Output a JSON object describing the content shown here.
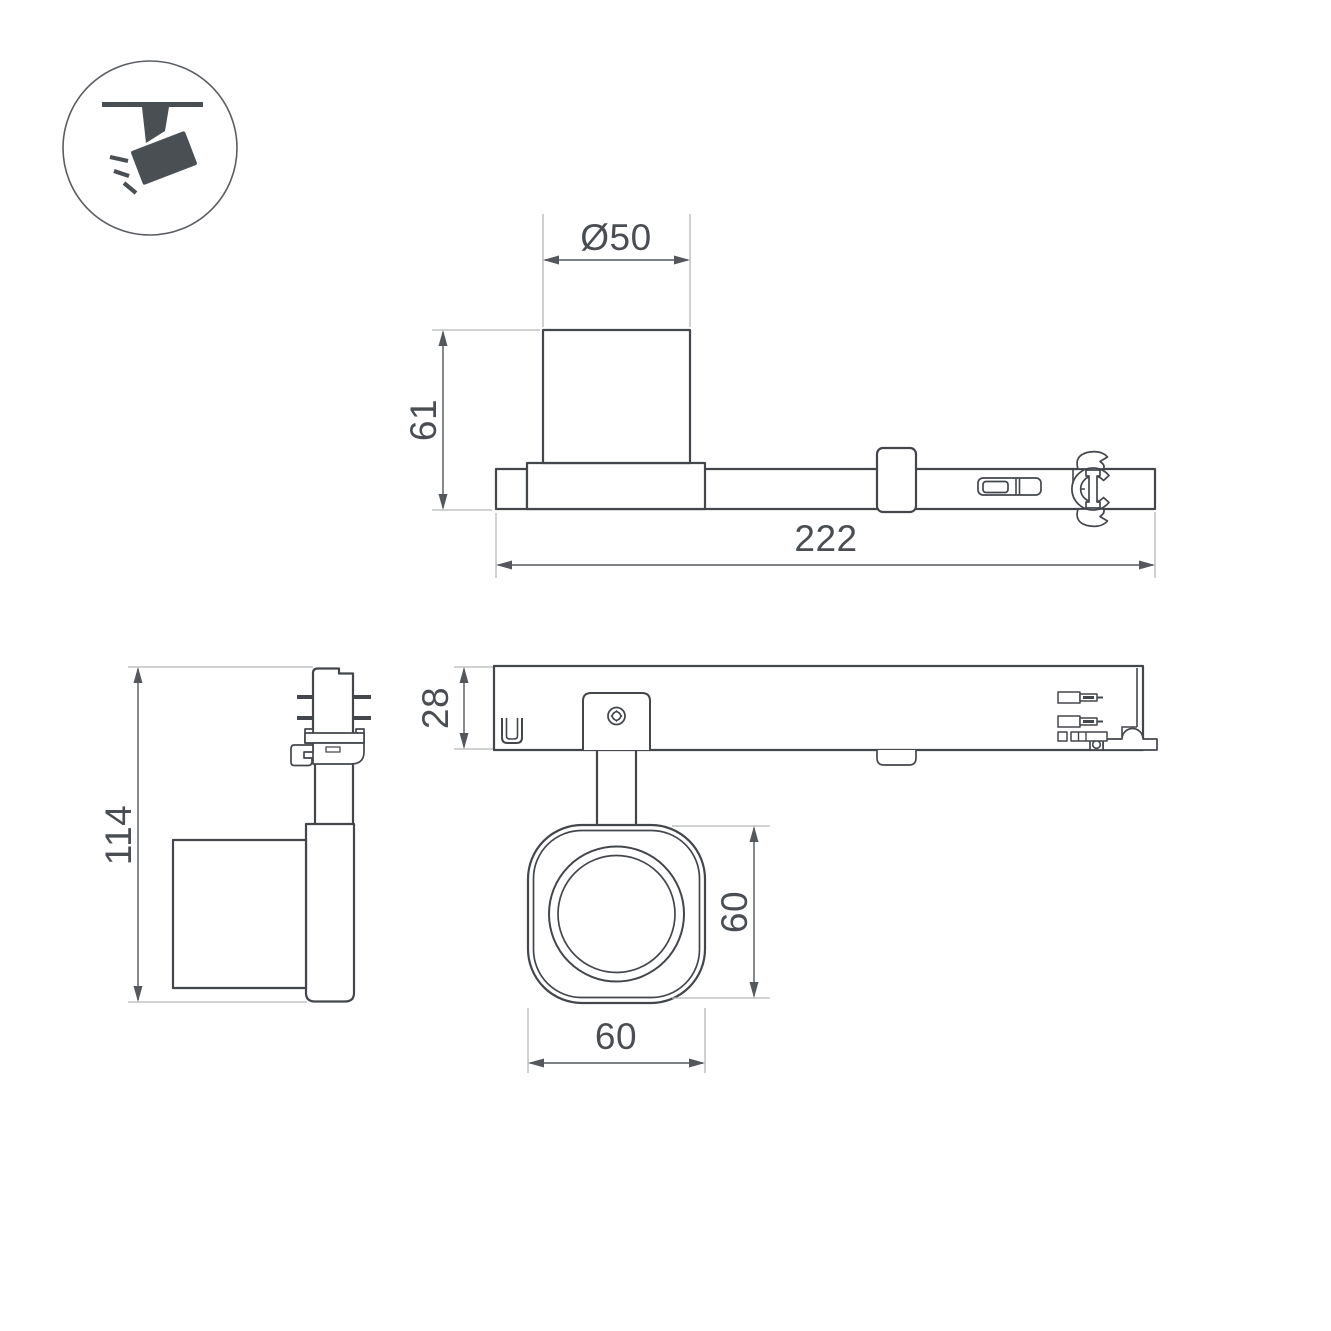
{
  "dims": {
    "diameter": "Ø50",
    "body_height": "61",
    "track_length": "222",
    "total_height": "114",
    "track_height": "28",
    "head_height": "60",
    "head_width": "60"
  },
  "icon": {
    "symbol": "ceiling-track-spotlight"
  },
  "colors": {
    "line": "#43474c",
    "dimension": "#54585c",
    "extension": "#b4b6b8",
    "icon_fill": "#4a4f54",
    "background": "#ffffff"
  }
}
